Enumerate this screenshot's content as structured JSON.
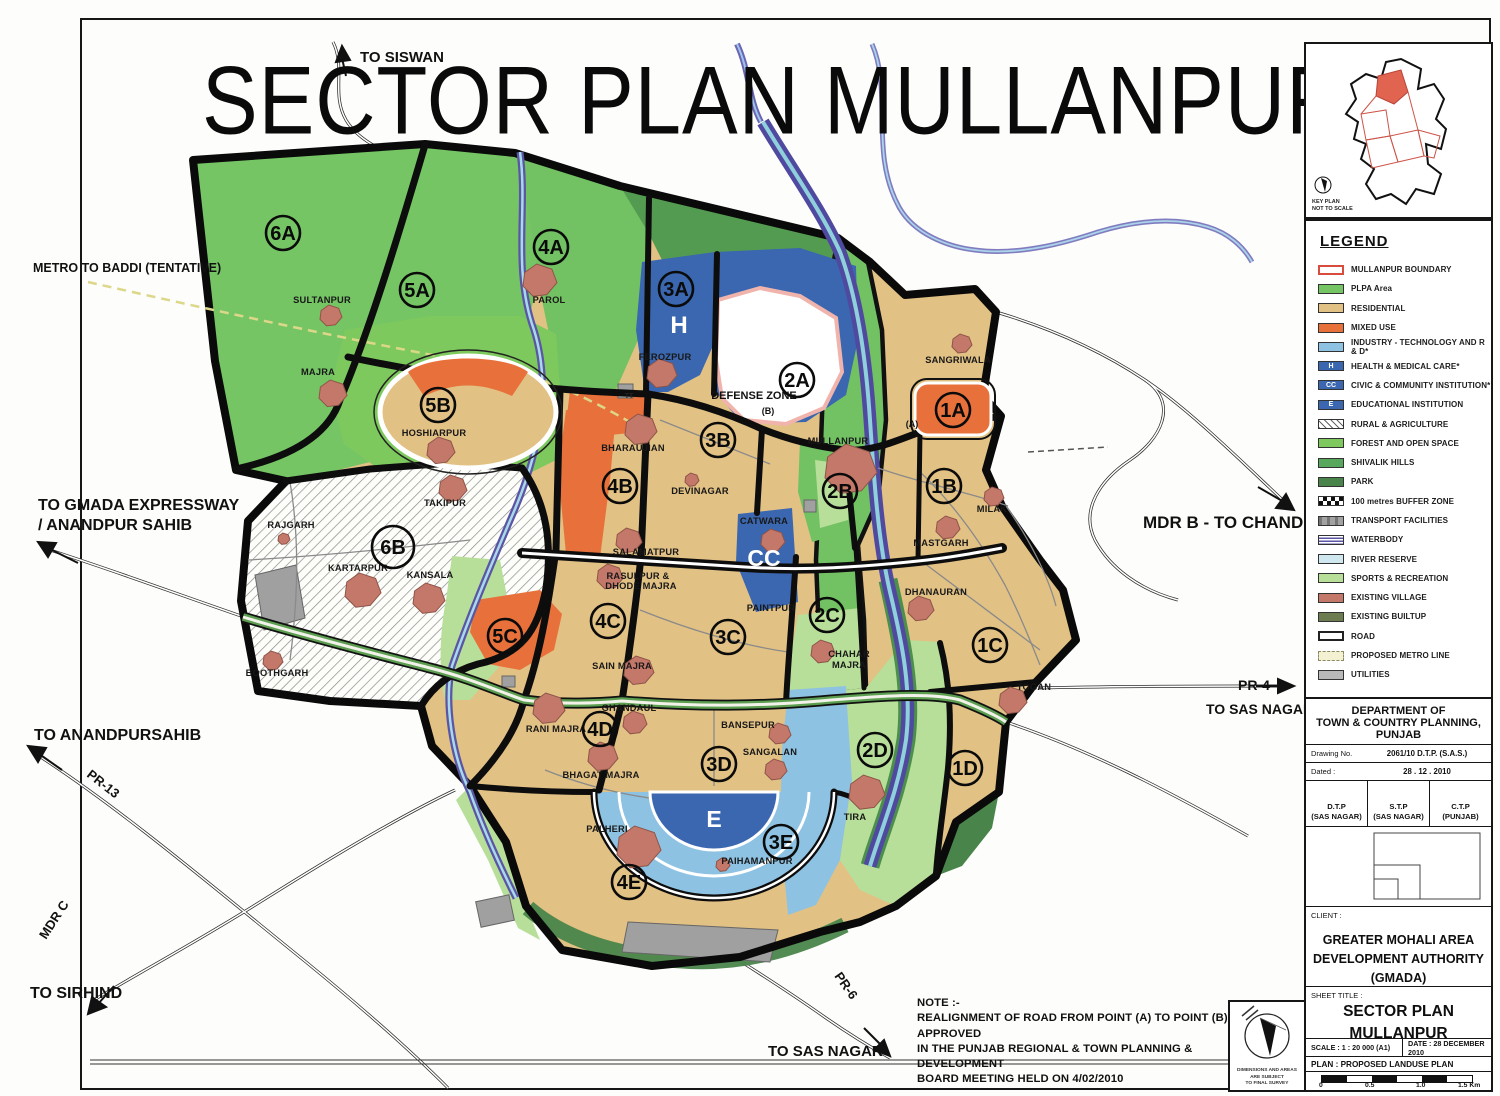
{
  "title": "SECTOR PLAN MULLANPUR",
  "key_plan": {
    "line1": "KEY PLAN",
    "line2": "NOT TO SCALE"
  },
  "legend": {
    "title": "LEGEND",
    "items": [
      {
        "label": "MULLANPUR BOUNDARY",
        "style": "boundary"
      },
      {
        "label": "PLPA Area",
        "color": "#76c565"
      },
      {
        "label": "RESIDENTIAL",
        "color": "#e2c184"
      },
      {
        "label": "MIXED USE",
        "color": "#e8713b"
      },
      {
        "label": "INDUSTRY - TECHNOLOGY AND R & D*",
        "color": "#8ec2e2"
      },
      {
        "label": "HEALTH & MEDICAL CARE*",
        "color": "#3a67af",
        "glyph": "H"
      },
      {
        "label": "CIVIC & COMMUNITY INSTITUTION*",
        "color": "#3a67af",
        "glyph": "CC"
      },
      {
        "label": "EDUCATIONAL INSTITUTION",
        "color": "#3a67af",
        "glyph": "E"
      },
      {
        "label": "RURAL & AGRICULTURE",
        "style": "hatch"
      },
      {
        "label": "FOREST AND OPEN SPACE",
        "color": "#7dc95e"
      },
      {
        "label": "SHIVALIK HILLS",
        "color": "#57a85c"
      },
      {
        "label": "PARK",
        "color": "#49854a"
      },
      {
        "label": "100 metres BUFFER ZONE",
        "style": "checker"
      },
      {
        "label": "TRANSPORT FACILITIES",
        "style": "transport"
      },
      {
        "label": "WATERBODY",
        "style": "waterbody"
      },
      {
        "label": "RIVER RESERVE",
        "color": "#cfe8ef"
      },
      {
        "label": "SPORTS & RECREATION",
        "color": "#b8df9a"
      },
      {
        "label": "EXISTING VILLAGE",
        "color": "#c4786a"
      },
      {
        "label": "EXISTING BUILTUP",
        "color": "#6d7c50"
      },
      {
        "label": "ROAD",
        "style": "road"
      },
      {
        "label": "PROPOSED METRO LINE",
        "style": "metro"
      },
      {
        "label": "UTILITIES",
        "color": "#b9b9b9"
      }
    ]
  },
  "title_block": {
    "dept1": "DEPARTMENT OF",
    "dept2": "TOWN & COUNTRY PLANNING, PUNJAB",
    "drawing_label": "Drawing No.",
    "drawing_value": "2061/10  D.T.P. (S.A.S.)",
    "dated_label": "Dated :",
    "dated_value": "28 . 12 . 2010",
    "officers": [
      "D.T.P\n(SAS NAGAR)",
      "S.T.P\n(SAS NAGAR)",
      "C.T.P\n(PUNJAB)"
    ],
    "client_label": "CLIENT :",
    "client_lines": [
      "GREATER MOHALI AREA",
      "DEVELOPMENT AUTHORITY",
      "(GMADA)"
    ],
    "sheet_title_label": "SHEET TITLE :",
    "sheet_title_lines": [
      "SECTOR PLAN",
      "MULLANPUR"
    ],
    "scale": "SCALE : 1 : 20 000 (A1)",
    "date": "DATE : 28 DECEMBER 2010",
    "plan": "PLAN : PROPOSED LANDUSE PLAN",
    "scalebar_labels": [
      "0",
      "0.5",
      "1.0",
      "1.5 Km"
    ]
  },
  "north_box": {
    "lines": [
      "DIMENSIONS AND AREAS",
      "ARE SUBJECT",
      "TO FINAL SURVEY"
    ]
  },
  "map": {
    "note_lines": [
      "NOTE :-",
      "REALIGNMENT OF ROAD FROM POINT (A) TO POINT (B) WAS APPROVED",
      "IN THE PUNJAB REGIONAL  & TOWN PLANNING & DEVELOPMENT",
      "BOARD MEETING HELD ON 4/02/2010"
    ],
    "sectors": [
      {
        "id": "6A",
        "x": 283,
        "y": 233
      },
      {
        "id": "5A",
        "x": 417,
        "y": 290
      },
      {
        "id": "4A",
        "x": 551,
        "y": 247
      },
      {
        "id": "3A",
        "x": 676,
        "y": 289
      },
      {
        "id": "2A",
        "x": 797,
        "y": 380
      },
      {
        "id": "1A",
        "x": 953,
        "y": 410
      },
      {
        "id": "5B",
        "x": 438,
        "y": 405
      },
      {
        "id": "4B",
        "x": 620,
        "y": 486
      },
      {
        "id": "3B",
        "x": 718,
        "y": 440
      },
      {
        "id": "2B",
        "x": 840,
        "y": 491
      },
      {
        "id": "1B",
        "x": 944,
        "y": 486
      },
      {
        "id": "6B",
        "x": 393,
        "y": 547,
        "r": 21
      },
      {
        "id": "5C",
        "x": 505,
        "y": 636
      },
      {
        "id": "4C",
        "x": 608,
        "y": 621
      },
      {
        "id": "3C",
        "x": 728,
        "y": 637
      },
      {
        "id": "2C",
        "x": 827,
        "y": 615
      },
      {
        "id": "1C",
        "x": 990,
        "y": 645
      },
      {
        "id": "4D",
        "x": 600,
        "y": 729
      },
      {
        "id": "3D",
        "x": 719,
        "y": 764
      },
      {
        "id": "2D",
        "x": 875,
        "y": 750
      },
      {
        "id": "1D",
        "x": 965,
        "y": 768
      },
      {
        "id": "4E",
        "x": 629,
        "y": 882
      },
      {
        "id": "3E",
        "x": 781,
        "y": 842
      }
    ],
    "zone_labels": [
      {
        "t": "H",
        "x": 679,
        "y": 333,
        "size": 24,
        "fill": "#ffffff"
      },
      {
        "t": "H",
        "x": 789,
        "y": 327,
        "size": 24,
        "fill": "#ffffff"
      },
      {
        "t": "CC",
        "x": 764,
        "y": 566,
        "size": 23,
        "fill": "#ffffff"
      },
      {
        "t": "E",
        "x": 714,
        "y": 827,
        "size": 23,
        "fill": "#ffffff"
      },
      {
        "t": "DEFENSE ZONE",
        "x": 754,
        "y": 399,
        "size": 11,
        "fill": "#111111",
        "bold": true
      },
      {
        "t": "(B)",
        "x": 768,
        "y": 414,
        "size": 9,
        "fill": "#111111"
      },
      {
        "t": "(A)",
        "x": 912,
        "y": 427,
        "size": 9,
        "fill": "#111111",
        "bold": true
      },
      {
        "t": "TT",
        "x": 629,
        "y": 398,
        "size": 7,
        "fill": "#222222"
      }
    ],
    "villages": [
      {
        "n": "SULTANPUR",
        "x": 322,
        "y": 303,
        "bx": 331,
        "by": 316,
        "s": 1.1
      },
      {
        "n": "MAJRA",
        "x": 318,
        "y": 375,
        "bx": 333,
        "by": 394,
        "s": 1.4
      },
      {
        "n": "PAROL",
        "x": 549,
        "y": 303,
        "bx": 540,
        "by": 281,
        "s": 1.7
      },
      {
        "n": "FEROZPUR",
        "x": 665,
        "y": 360,
        "bx": 662,
        "by": 374,
        "s": 1.5
      },
      {
        "n": "SANGRIWALA",
        "x": 958,
        "y": 363,
        "bx": 962,
        "by": 344,
        "s": 1.0
      },
      {
        "n": "MULLANPUR",
        "x": 838,
        "y": 444,
        "bx": 851,
        "by": 470,
        "s": 2.6
      },
      {
        "n": "BHARAUJIAN",
        "x": 633,
        "y": 451,
        "bx": 641,
        "by": 430,
        "s": 1.6
      },
      {
        "n": "DEVINAGAR",
        "x": 700,
        "y": 494,
        "bx": 692,
        "by": 480,
        "s": 0.7
      },
      {
        "n": "MILAK",
        "x": 992,
        "y": 512,
        "bx": 994,
        "by": 497,
        "s": 1.0
      },
      {
        "n": "MASTGARH",
        "x": 941,
        "y": 546,
        "bx": 948,
        "by": 528,
        "s": 1.2
      },
      {
        "n": "SALAMATPUR",
        "x": 646,
        "y": 555,
        "bx": 629,
        "by": 541,
        "s": 1.3
      },
      {
        "n": "RASULPUR &",
        "x": 638,
        "y": 579,
        "bx": 610,
        "by": 577,
        "s": 1.3
      },
      {
        "n": "DHODE MAJRA",
        "x": 641,
        "y": 589,
        "s": 0
      },
      {
        "n": "CATWARA",
        "x": 764,
        "y": 524,
        "bx": 773,
        "by": 541,
        "s": 1.2
      },
      {
        "n": "PAINTPUR",
        "x": 771,
        "y": 611,
        "s": 0
      },
      {
        "n": "DHANAURAN",
        "x": 936,
        "y": 595,
        "bx": 921,
        "by": 609,
        "s": 1.3
      },
      {
        "n": "CHAHAR",
        "x": 849,
        "y": 657,
        "bx": 823,
        "by": 652,
        "s": 1.2
      },
      {
        "n": "MAJRA",
        "x": 849,
        "y": 668,
        "s": 0
      },
      {
        "n": "SAIN MAJRA",
        "x": 622,
        "y": 669,
        "bx": 639,
        "by": 671,
        "s": 1.5
      },
      {
        "n": "GHANDAUL",
        "x": 629,
        "y": 711,
        "bx": 635,
        "by": 723,
        "s": 1.2
      },
      {
        "n": "RANI MAJRA",
        "x": 556,
        "y": 732,
        "bx": 549,
        "by": 709,
        "s": 1.6
      },
      {
        "n": "BHAGAT MAJRA",
        "x": 601,
        "y": 778,
        "bx": 603,
        "by": 757,
        "s": 1.5
      },
      {
        "n": "BANSEPUR",
        "x": 748,
        "y": 728,
        "bx": 780,
        "by": 734,
        "s": 1.1
      },
      {
        "n": "SANGALAN",
        "x": 770,
        "y": 755,
        "bx": 776,
        "by": 770,
        "s": 1.1
      },
      {
        "n": "TIRA",
        "x": 855,
        "y": 820,
        "bx": 867,
        "by": 793,
        "s": 1.8
      },
      {
        "n": "PALHERI",
        "x": 607,
        "y": 832,
        "bx": 639,
        "by": 848,
        "s": 2.2
      },
      {
        "n": "PAIHAMANPUR",
        "x": 757,
        "y": 864,
        "bx": 723,
        "by": 865,
        "s": 0.7
      },
      {
        "n": "TOGAN",
        "x": 1034,
        "y": 690,
        "bx": 1013,
        "by": 701,
        "s": 1.4
      },
      {
        "n": "KARTARPUR",
        "x": 358,
        "y": 571,
        "bx": 363,
        "by": 591,
        "s": 1.8
      },
      {
        "n": "KANSALA",
        "x": 430,
        "y": 578,
        "bx": 429,
        "by": 599,
        "s": 1.6
      },
      {
        "n": "TAKIPUR",
        "x": 445,
        "y": 506,
        "bx": 453,
        "by": 489,
        "s": 1.4
      },
      {
        "n": "HOSHIARPUR",
        "x": 434,
        "y": 436,
        "bx": 441,
        "by": 451,
        "s": 1.4
      },
      {
        "n": "RAJGARH",
        "x": 291,
        "y": 528,
        "bx": 284,
        "by": 539,
        "s": 0.6
      },
      {
        "n": "BOOTHGARH",
        "x": 277,
        "y": 676,
        "bx": 273,
        "by": 661,
        "s": 1.0
      }
    ],
    "external_labels": [
      {
        "t": "TO SISWAN",
        "x": 360,
        "y": 62,
        "size": 15
      },
      {
        "t": "METRO TO BADDI (TENTATIVE)",
        "x": 33,
        "y": 272,
        "size": 12.5
      },
      {
        "t": "TO GMADA EXPRESSWAY",
        "x": 38,
        "y": 510,
        "size": 16
      },
      {
        "t": "/ ANANDPUR SAHIB",
        "x": 38,
        "y": 530,
        "size": 16
      },
      {
        "t": "TO ANANDPURSAHIB",
        "x": 34,
        "y": 740,
        "size": 16
      },
      {
        "t": "PR-13",
        "x": 86,
        "y": 776,
        "size": 13,
        "rot": 38
      },
      {
        "t": "MDR C",
        "x": 46,
        "y": 940,
        "size": 13,
        "rot": -57
      },
      {
        "t": "TO SIRHIND",
        "x": 30,
        "y": 998,
        "size": 16
      },
      {
        "t": "MDR B - TO CHANDIGARH",
        "x": 1143,
        "y": 528,
        "size": 17
      },
      {
        "t": "PR-4",
        "x": 1238,
        "y": 690,
        "size": 14
      },
      {
        "t": "TO SAS NAGAR",
        "x": 1206,
        "y": 714,
        "size": 14
      },
      {
        "t": "PR-6",
        "x": 834,
        "y": 976,
        "size": 13,
        "rot": 55
      },
      {
        "t": "TO SAS NAGAR",
        "x": 768,
        "y": 1056,
        "size": 15
      }
    ]
  },
  "colors": {
    "residential": "#e2c184",
    "mixed_use": "#e8713b",
    "plpa": "#76c565",
    "forest": "#7dc95e",
    "shivalik": "#57a85c",
    "park": "#49854a",
    "institution_blue": "#3a67af",
    "industry_blue": "#8ec2e2",
    "sports_green": "#b8df9a",
    "village_red": "#c4786a",
    "river": "#5a55a5",
    "boundary_red": "#d84c3e",
    "utilities_gray": "#a0a0a0"
  }
}
